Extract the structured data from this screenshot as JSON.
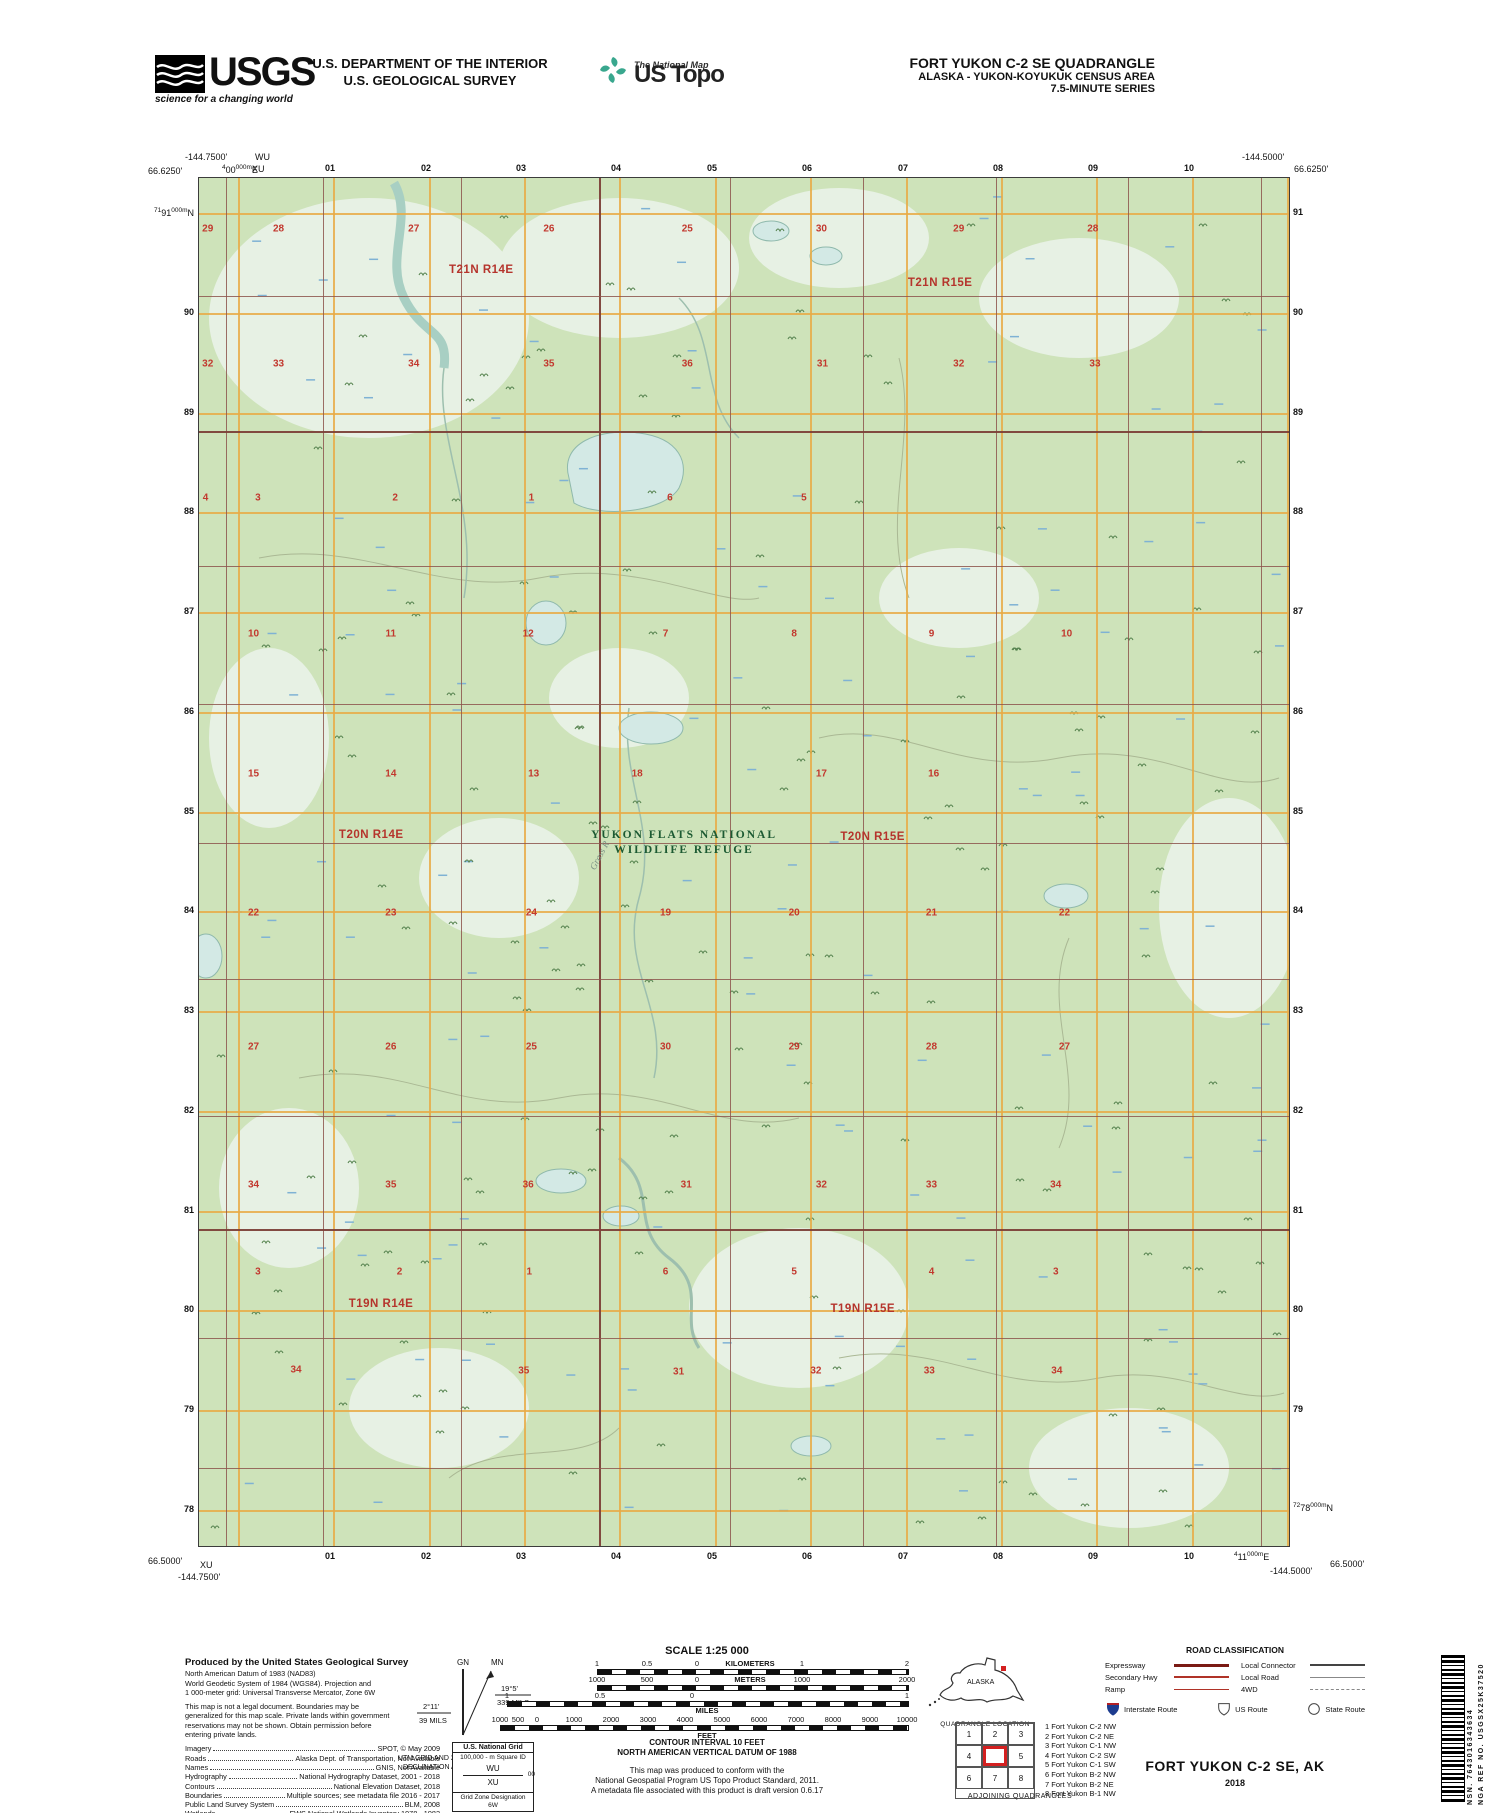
{
  "header": {
    "usgs_logo_text": "USGS",
    "usgs_tagline": "science for a changing world",
    "dept_line1": "U.S. DEPARTMENT OF THE INTERIOR",
    "dept_line2": "U.S. GEOLOGICAL SURVEY",
    "ustopo_small": "The National Map",
    "ustopo_big": "US Topo",
    "quad_line1": "FORT YUKON C-2 SE QUADRANGLE",
    "quad_line2": "ALASKA - YUKON-KOYUKUK CENSUS AREA",
    "quad_line3": "7.5-MINUTE SERIES"
  },
  "map": {
    "corners": {
      "top_left": {
        "lon": "-144.7500'",
        "lat": "66.6250'",
        "sq_top": "WU",
        "sq": "XU"
      },
      "top_right": {
        "lon": "-144.5000'",
        "lat": "66.6250'"
      },
      "bottom_left": {
        "lat": "66.5000'",
        "sq": "XU",
        "lon": "-144.7500'"
      },
      "bottom_right": {
        "lon": "-144.5000'",
        "lat": "66.5000'"
      }
    },
    "grid": {
      "top_numbers": [
        "01",
        "02",
        "03",
        "04",
        "05",
        "06",
        "07",
        "08",
        "09",
        "10"
      ],
      "bottom_numbers": [
        "01",
        "02",
        "03",
        "04",
        "05",
        "06",
        "07",
        "08",
        "09",
        "10"
      ],
      "left_numbers": [
        "90",
        "89",
        "88",
        "87",
        "86",
        "85",
        "84",
        "83",
        "82",
        "81",
        "80",
        "79",
        "78"
      ],
      "right_numbers": [
        "91",
        "90",
        "89",
        "88",
        "87",
        "86",
        "85",
        "84",
        "83",
        "82",
        "81",
        "80",
        "79"
      ],
      "left_first_label": {
        "sup": "71",
        "main": "91",
        "sup2": "000m",
        "suffix": "N"
      },
      "right_last_label": {
        "sup": "72",
        "main": "78",
        "sup2": "000m",
        "suffix": "N"
      },
      "top_utm_label": {
        "sup": "4",
        "main": "00",
        "sup2": "000m",
        "suffix": "E"
      },
      "bottom_utm_label": {
        "sup": "4",
        "main": "11",
        "sup2": "000m",
        "suffix": "E"
      }
    },
    "townships": [
      {
        "text": "T21N R14E",
        "x": 25.9,
        "y": 6.7
      },
      {
        "text": "T21N R15E",
        "x": 68.0,
        "y": 7.7
      },
      {
        "text": "T20N R14E",
        "x": 15.8,
        "y": 48.0
      },
      {
        "text": "T20N R15E",
        "x": 61.8,
        "y": 48.2
      },
      {
        "text": "T19N R14E",
        "x": 16.7,
        "y": 82.3
      },
      {
        "text": "T19N R15E",
        "x": 60.9,
        "y": 82.7
      }
    ],
    "refuge_label": {
      "line1": "YUKON FLATS NATIONAL",
      "line2": "WILDLIFE REFUGE",
      "x": 44.5,
      "y": 48.6
    },
    "river_label": {
      "text": "Grass R",
      "x": 35.4,
      "y": 49.2,
      "rotate": -62
    },
    "sections": [
      {
        "n": "29",
        "x": 0.8,
        "y": 3.7
      },
      {
        "n": "28",
        "x": 7.3,
        "y": 3.7
      },
      {
        "n": "27",
        "x": 19.7,
        "y": 3.7
      },
      {
        "n": "26",
        "x": 32.1,
        "y": 3.7
      },
      {
        "n": "25",
        "x": 44.8,
        "y": 3.7
      },
      {
        "n": "30",
        "x": 57.1,
        "y": 3.7
      },
      {
        "n": "29",
        "x": 69.7,
        "y": 3.7
      },
      {
        "n": "28",
        "x": 82.0,
        "y": 3.7
      },
      {
        "n": "32",
        "x": 0.8,
        "y": 13.6
      },
      {
        "n": "33",
        "x": 7.3,
        "y": 13.6
      },
      {
        "n": "34",
        "x": 19.7,
        "y": 13.6
      },
      {
        "n": "35",
        "x": 32.1,
        "y": 13.6
      },
      {
        "n": "36",
        "x": 44.8,
        "y": 13.6
      },
      {
        "n": "31",
        "x": 57.2,
        "y": 13.6
      },
      {
        "n": "32",
        "x": 69.7,
        "y": 13.6
      },
      {
        "n": "33",
        "x": 82.2,
        "y": 13.6
      },
      {
        "n": "4",
        "x": 0.6,
        "y": 23.4
      },
      {
        "n": "3",
        "x": 5.4,
        "y": 23.4
      },
      {
        "n": "2",
        "x": 18.0,
        "y": 23.4
      },
      {
        "n": "1",
        "x": 30.5,
        "y": 23.4
      },
      {
        "n": "6",
        "x": 43.2,
        "y": 23.4
      },
      {
        "n": "5",
        "x": 55.5,
        "y": 23.4
      },
      {
        "n": "10",
        "x": 5.0,
        "y": 33.3
      },
      {
        "n": "11",
        "x": 17.6,
        "y": 33.3
      },
      {
        "n": "12",
        "x": 30.2,
        "y": 33.3
      },
      {
        "n": "7",
        "x": 42.8,
        "y": 33.3
      },
      {
        "n": "8",
        "x": 54.6,
        "y": 33.3
      },
      {
        "n": "9",
        "x": 67.2,
        "y": 33.3
      },
      {
        "n": "10",
        "x": 79.6,
        "y": 33.3
      },
      {
        "n": "15",
        "x": 5.0,
        "y": 43.6
      },
      {
        "n": "14",
        "x": 17.6,
        "y": 43.6
      },
      {
        "n": "13",
        "x": 30.7,
        "y": 43.6
      },
      {
        "n": "18",
        "x": 40.2,
        "y": 43.6
      },
      {
        "n": "17",
        "x": 57.1,
        "y": 43.6
      },
      {
        "n": "16",
        "x": 67.4,
        "y": 43.6
      },
      {
        "n": "22",
        "x": 5.0,
        "y": 53.7
      },
      {
        "n": "23",
        "x": 17.6,
        "y": 53.7
      },
      {
        "n": "24",
        "x": 30.5,
        "y": 53.7
      },
      {
        "n": "19",
        "x": 42.8,
        "y": 53.7
      },
      {
        "n": "20",
        "x": 54.6,
        "y": 53.7
      },
      {
        "n": "21",
        "x": 67.2,
        "y": 53.7
      },
      {
        "n": "22",
        "x": 79.4,
        "y": 53.7
      },
      {
        "n": "27",
        "x": 5.0,
        "y": 63.5
      },
      {
        "n": "26",
        "x": 17.6,
        "y": 63.5
      },
      {
        "n": "25",
        "x": 30.5,
        "y": 63.5
      },
      {
        "n": "30",
        "x": 42.8,
        "y": 63.5
      },
      {
        "n": "29",
        "x": 54.6,
        "y": 63.5
      },
      {
        "n": "28",
        "x": 67.2,
        "y": 63.5
      },
      {
        "n": "27",
        "x": 79.4,
        "y": 63.5
      },
      {
        "n": "34",
        "x": 5.0,
        "y": 73.6
      },
      {
        "n": "35",
        "x": 17.6,
        "y": 73.6
      },
      {
        "n": "36",
        "x": 30.2,
        "y": 73.6
      },
      {
        "n": "31",
        "x": 44.7,
        "y": 73.6
      },
      {
        "n": "32",
        "x": 57.1,
        "y": 73.6
      },
      {
        "n": "33",
        "x": 67.2,
        "y": 73.6
      },
      {
        "n": "34",
        "x": 78.6,
        "y": 73.6
      },
      {
        "n": "3",
        "x": 5.4,
        "y": 80.0
      },
      {
        "n": "2",
        "x": 18.4,
        "y": 80.0
      },
      {
        "n": "1",
        "x": 30.3,
        "y": 80.0
      },
      {
        "n": "6",
        "x": 42.8,
        "y": 80.0
      },
      {
        "n": "5",
        "x": 54.6,
        "y": 80.0
      },
      {
        "n": "4",
        "x": 67.2,
        "y": 80.0
      },
      {
        "n": "3",
        "x": 78.6,
        "y": 80.0
      },
      {
        "n": "34",
        "x": 8.9,
        "y": 87.1
      },
      {
        "n": "35",
        "x": 29.8,
        "y": 87.2
      },
      {
        "n": "31",
        "x": 44.0,
        "y": 87.3
      },
      {
        "n": "32",
        "x": 56.6,
        "y": 87.2
      },
      {
        "n": "33",
        "x": 67.0,
        "y": 87.2
      },
      {
        "n": "34",
        "x": 78.7,
        "y": 87.2
      }
    ]
  },
  "footer": {
    "credits": {
      "title": "Produced by the United States Geological Survey",
      "body": [
        "North American Datum of 1983 (NAD83)",
        "World Geodetic System of 1984 (WGS84).  Projection and",
        "1 000-meter grid: Universal Transverse Mercator, Zone 6W",
        "",
        "This map is not a legal document. Boundaries may be",
        "generalized for this map scale. Private lands within government",
        "reservations may not be shown. Obtain permission before",
        "entering private lands."
      ],
      "sources": [
        {
          "label": "Imagery",
          "value": "SPOT, © May 2009"
        },
        {
          "label": "Roads",
          "value": "Alaska Dept. of Transportation, Not Available"
        },
        {
          "label": "Names",
          "value": "GNIS, Not Available"
        },
        {
          "label": "Hydrography",
          "value": "National Hydrography Dataset, 2001 - 2018"
        },
        {
          "label": "Contours",
          "value": "National Elevation Dataset, 2018"
        },
        {
          "label": "Boundaries",
          "value": "Multiple sources; see metadata file 2016 - 2017"
        },
        {
          "label": "Public Land Survey System",
          "value": "BLM, 2008"
        },
        {
          "label": "Wetlands",
          "value": "FWS National Wetlands Inventory 1978 - 1982"
        }
      ]
    },
    "declination": {
      "gn": "GN",
      "mn": "MN",
      "utm_angle": "2°11'",
      "utm_mils": "39 MILS",
      "mag_angle": "19°5'",
      "mag_mils": "339 MILS",
      "caption1": "UTM GRID AND 2017 MAGNETIC NORTH",
      "caption2": "DECLINATION AT CENTER OF SHEET"
    },
    "usng": {
      "title": "U.S. National Grid",
      "subtitle": "100,000 - m Square ID",
      "sq1": "WU",
      "mid": "00",
      "sq2": "XU",
      "zone_label": "Grid Zone Designation",
      "zone": "6W"
    },
    "scale": {
      "title": "SCALE 1:25 000",
      "km_ticks": [
        {
          "t": "1",
          "x": 105
        },
        {
          "t": "0.5",
          "x": 155
        },
        {
          "t": "0",
          "x": 205
        },
        {
          "t": "KILOMETERS",
          "x": 258,
          "lab": true
        },
        {
          "t": "1",
          "x": 310
        },
        {
          "t": "2",
          "x": 415
        }
      ],
      "m_ticks": [
        {
          "t": "1000",
          "x": 105
        },
        {
          "t": "500",
          "x": 155
        },
        {
          "t": "0",
          "x": 205
        },
        {
          "t": "METERS",
          "x": 258,
          "lab": true
        },
        {
          "t": "1000",
          "x": 310
        },
        {
          "t": "2000",
          "x": 415
        }
      ],
      "mi_ticks": [
        {
          "t": "1",
          "x": 15
        },
        {
          "t": "0.5",
          "x": 108
        },
        {
          "t": "0",
          "x": 200
        },
        {
          "t": "1",
          "x": 415
        }
      ],
      "mi_label": "MILES",
      "ft_ticks": [
        {
          "t": "1000",
          "x": 8
        },
        {
          "t": "500",
          "x": 26
        },
        {
          "t": "0",
          "x": 45
        },
        {
          "t": "1000",
          "x": 82
        },
        {
          "t": "2000",
          "x": 119
        },
        {
          "t": "3000",
          "x": 156
        },
        {
          "t": "4000",
          "x": 193
        },
        {
          "t": "5000",
          "x": 230
        },
        {
          "t": "6000",
          "x": 267
        },
        {
          "t": "7000",
          "x": 304
        },
        {
          "t": "8000",
          "x": 341
        },
        {
          "t": "9000",
          "x": 378
        },
        {
          "t": "10000",
          "x": 415
        }
      ],
      "ft_label": "FEET"
    },
    "notes": {
      "contour1": "CONTOUR INTERVAL 10 FEET",
      "contour2": "NORTH AMERICAN VERTICAL DATUM OF 1988",
      "std1": "This map was produced to conform with the",
      "std2": "National Geospatial Program US Topo Product Standard, 2011.",
      "std3": "A metadata file associated with this product is draft version 0.6.17"
    },
    "quad_location": {
      "state": "ALASKA",
      "caption": "QUADRANGLE LOCATION"
    },
    "adjoining": {
      "cells": [
        "1",
        "2",
        "3",
        "4",
        "",
        "5",
        "6",
        "7",
        "8"
      ],
      "names": [
        "1 Fort Yukon C-2 NW",
        "2 Fort Yukon C-2 NE",
        "3 Fort Yukon C-1 NW",
        "4 Fort Yukon C-2 SW",
        "5 Fort Yukon C-1 SW",
        "6 Fort Yukon B-2 NW",
        "7 Fort Yukon B-2 NE",
        "8 Fort Yukon B-1 NW"
      ],
      "caption": "ADJOINING QUADRANGLES"
    },
    "road_class": {
      "title": "ROAD CLASSIFICATION",
      "left": [
        {
          "label": "Expressway",
          "style": "rc-expressway"
        },
        {
          "label": "Secondary Hwy",
          "style": "rc-secondary"
        },
        {
          "label": "Ramp",
          "style": "rc-ramp"
        }
      ],
      "right": [
        {
          "label": "Local Connector",
          "style": "rc-connector"
        },
        {
          "label": "Local Road",
          "style": "rc-local"
        },
        {
          "label": "4WD",
          "style": "rc-fourwd"
        }
      ],
      "routes": [
        {
          "label": "Interstate Route",
          "icon": "interstate"
        },
        {
          "label": "US Route",
          "icon": "us"
        },
        {
          "label": "State Route",
          "icon": "state"
        }
      ]
    },
    "title_block": {
      "title": "FORT YUKON C-2 SE,  AK",
      "year": "2018"
    },
    "barcode": {
      "nsn": "NSN.  7643016343634",
      "nga": "NGA REF NO.  USGSX25K37520"
    }
  },
  "colors": {
    "map_green": "#cee3ba",
    "wetland_pale": "#e7f1e4",
    "water_fill": "#d3e9e5",
    "water_stroke": "#8fb9ac",
    "grid_orange": "#e8aa45",
    "section_line": "#8d564d",
    "section_number": "#c2382e",
    "township_red": "#b5342c",
    "refuge_green": "#1c5a32"
  }
}
